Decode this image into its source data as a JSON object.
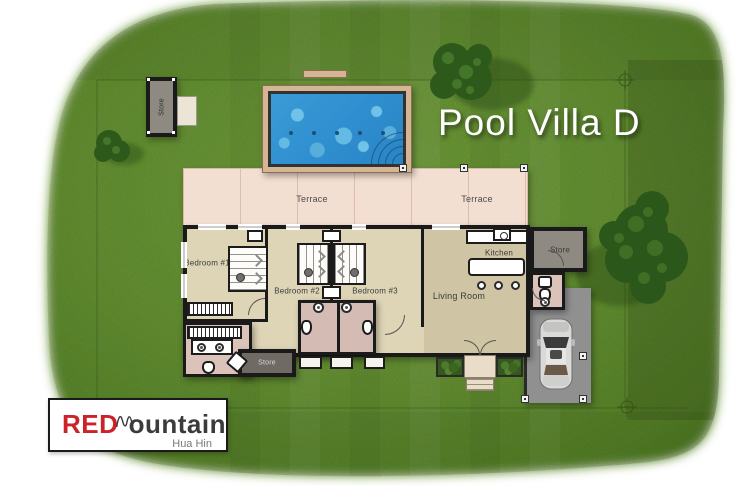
{
  "title": "Pool Villa D",
  "logo": {
    "brand_red": "RED",
    "brand_rest": "ountain",
    "location": "Hua Hin"
  },
  "plan": {
    "terrace_left": "Terrace",
    "terrace_right": "Terrace",
    "bedroom1": "Bedroom #1",
    "bedroom2": "Bedroom #2",
    "bedroom3": "Bedroom #3",
    "living": "Living Room",
    "kitchen": "Kitchen",
    "store_right": "Store",
    "store_bottom": "Store",
    "store_outbuilding": "Store"
  },
  "colors": {
    "lawn": "#699734",
    "pool_water": "#3093cf",
    "pool_deck": "#d4b594",
    "terrace": "#f3ded2",
    "floor": "#ded4b6",
    "bathroom": "#dcc3ba",
    "store_floor": "#8e8a82",
    "wall": "#1a1a1a",
    "driveway": "#909090",
    "logo_red": "#cc2229",
    "logo_dark": "#3b3b3d"
  }
}
